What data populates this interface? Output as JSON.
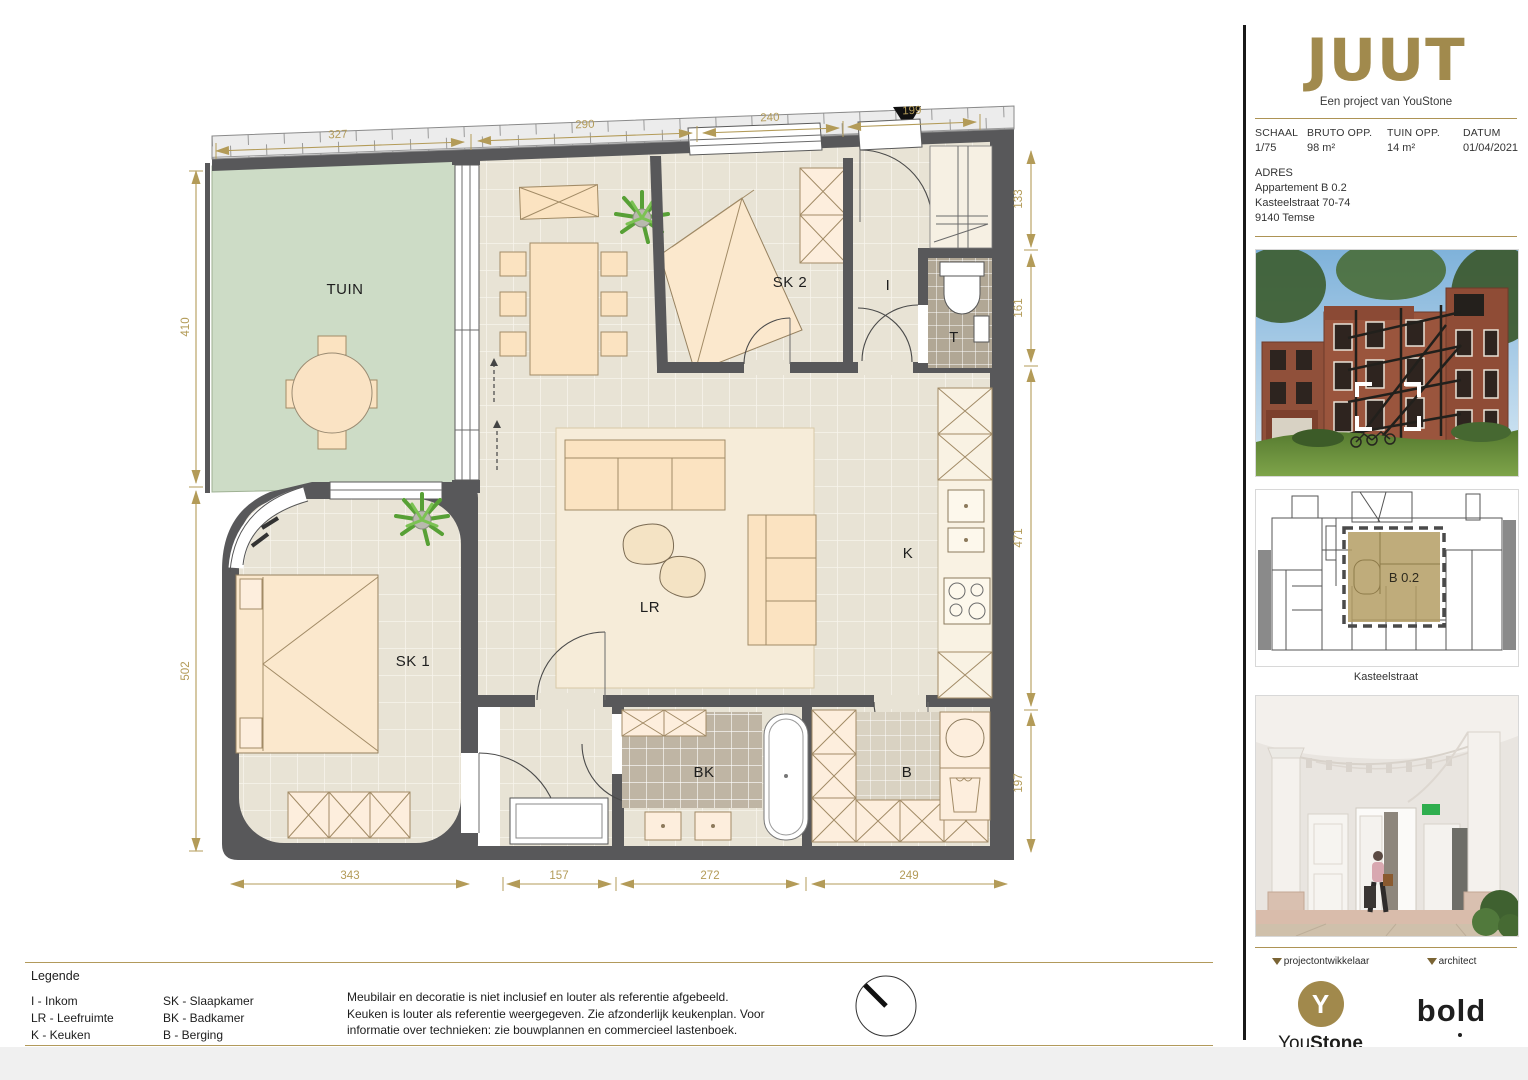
{
  "plan": {
    "rooms": {
      "tuin": "TUIN",
      "sk2": "SK 2",
      "i": "I",
      "t": "T",
      "k": "K",
      "lr": "LR",
      "sk1": "SK 1",
      "bk": "BK",
      "b": "B"
    },
    "dims": {
      "top": [
        "327",
        "290",
        "240",
        "199"
      ],
      "left": [
        "410",
        "502"
      ],
      "right": [
        "133",
        "161",
        "471",
        "197"
      ],
      "bottom": [
        "343",
        "157",
        "272",
        "249"
      ]
    }
  },
  "legend": {
    "title": "Legende",
    "col1": [
      "I - Inkom",
      "LR - Leefruimte",
      "K - Keuken",
      "T - Terras / Tuin"
    ],
    "col2": [
      "SK - Slaapkamer",
      "BK - Badkamer",
      "B - Berging"
    ],
    "disclaimer": "Meubilair en decoratie is niet inclusief en louter als referentie afgebeeld. Keuken is louter als referentie weergegeven. Zie afzonderlijk keukenplan. Voor informatie over technieken: zie bouwplannen en commercieel lastenboek."
  },
  "sidebar": {
    "logo": "JUUT",
    "tagline": "Een project van YouStone",
    "info": {
      "schaal_label": "SCHAAL",
      "schaal_value": "1/75",
      "bruto_label": "BRUTO OPP.",
      "bruto_value": "98 m²",
      "tuin_label": "TUIN OPP.",
      "tuin_value": "14 m²",
      "datum_label": "DATUM",
      "datum_value": "01/04/2021"
    },
    "adres": {
      "label": "ADRES",
      "line1": "Appartement B 0.2",
      "line2": "Kasteelstraat 70-74",
      "line3": "9140 Temse"
    },
    "siteplan": {
      "unit": "B 0.2",
      "street": "Kasteelstraat"
    },
    "footer": {
      "dev_label": "projectontwikkelaar",
      "dev_initial": "Y",
      "dev_name_1": "You",
      "dev_name_2": "Stone",
      "dev_tagline": "BRINGS YOU® HOME",
      "arch_label": "architect",
      "arch_name": "bold"
    }
  },
  "colors": {
    "gold": "#b39b58",
    "wall": "#58585a",
    "floor": "#e8e3d5",
    "garden": "#cddcc6"
  }
}
